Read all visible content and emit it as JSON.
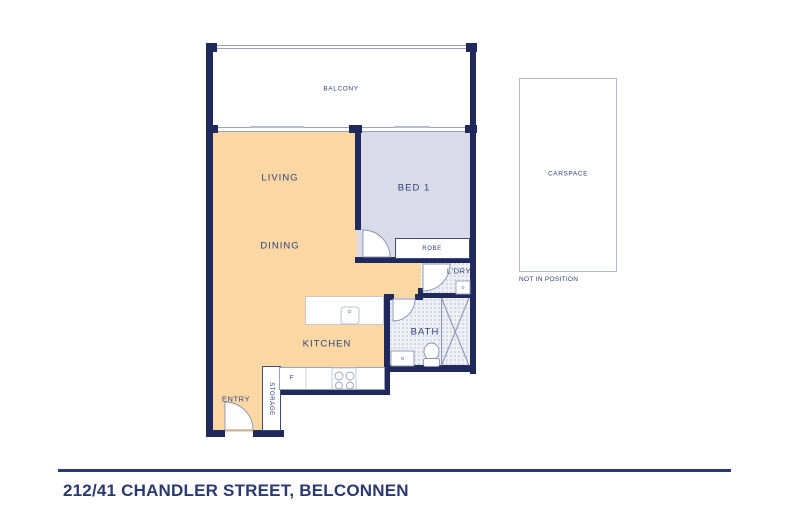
{
  "address": "212/41 CHANDLER STREET, BELCONNEN",
  "plan": {
    "rooms": {
      "balcony": "BALCONY",
      "living": "LIVING",
      "dining": "DINING",
      "bed1": "BED 1",
      "robe": "ROBE",
      "laundry": "L'DRY",
      "bath": "BATH",
      "kitchen": "KITCHEN",
      "entry": "ENTRY",
      "storage": "STORAGE",
      "fridge": "F"
    },
    "carspace": {
      "label": "CARSPACE",
      "note": "NOT IN POSITION"
    }
  },
  "colors": {
    "wall": "#20295c",
    "living": "#fad7a3",
    "bed": "#d9dbe8",
    "wetbase": "#eef0f6",
    "wetdot": "#ccd1e0",
    "window": "#9aa3ba",
    "label": "#31407c",
    "accent": "#2b3a6e",
    "fixture": "#8892b2"
  }
}
